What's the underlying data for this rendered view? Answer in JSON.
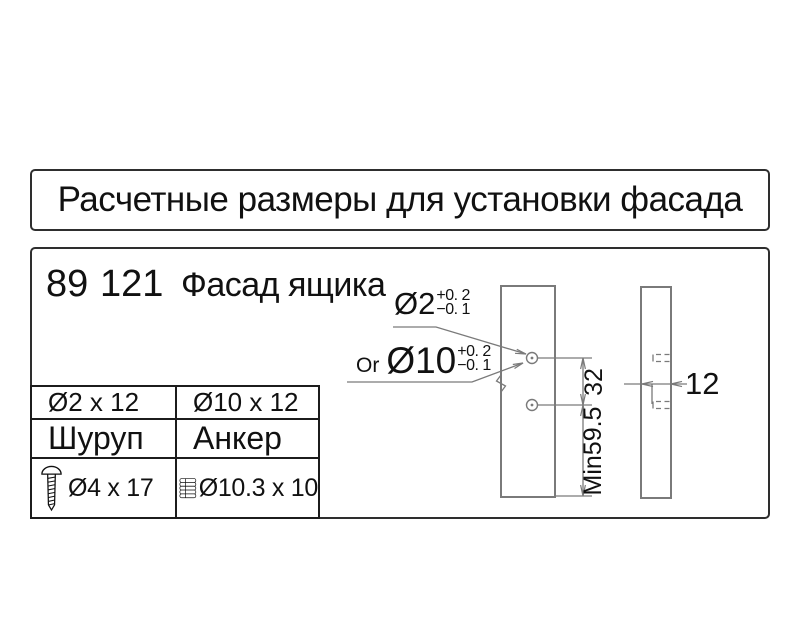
{
  "title": "Расчетные размеры для установки фасада",
  "header": {
    "num1": "89",
    "num2": "121",
    "label": "Фасад ящика"
  },
  "table": {
    "col1": [
      "Ø2 x 12",
      "Шуруп",
      "Ø4 x 17"
    ],
    "col2": [
      "Ø10 x 12",
      "Анкер",
      "Ø10.3 x 10"
    ],
    "icons": [
      "screw-icon",
      "anchor-icon"
    ]
  },
  "drawing": {
    "or_label": "Or",
    "d2": "Ø2",
    "d2_tol_plus": "+0. 2",
    "d2_tol_minus": "−0. 1",
    "d10": "Ø10",
    "d10_tol_plus": "+0. 2",
    "d10_tol_minus": "−0. 1",
    "spacing": "32",
    "min_height": "Min59.5",
    "thickness": "12"
  },
  "colors": {
    "ink": "#111111",
    "line_gray": "#7a7a7a",
    "border": "#2e2e2e"
  }
}
